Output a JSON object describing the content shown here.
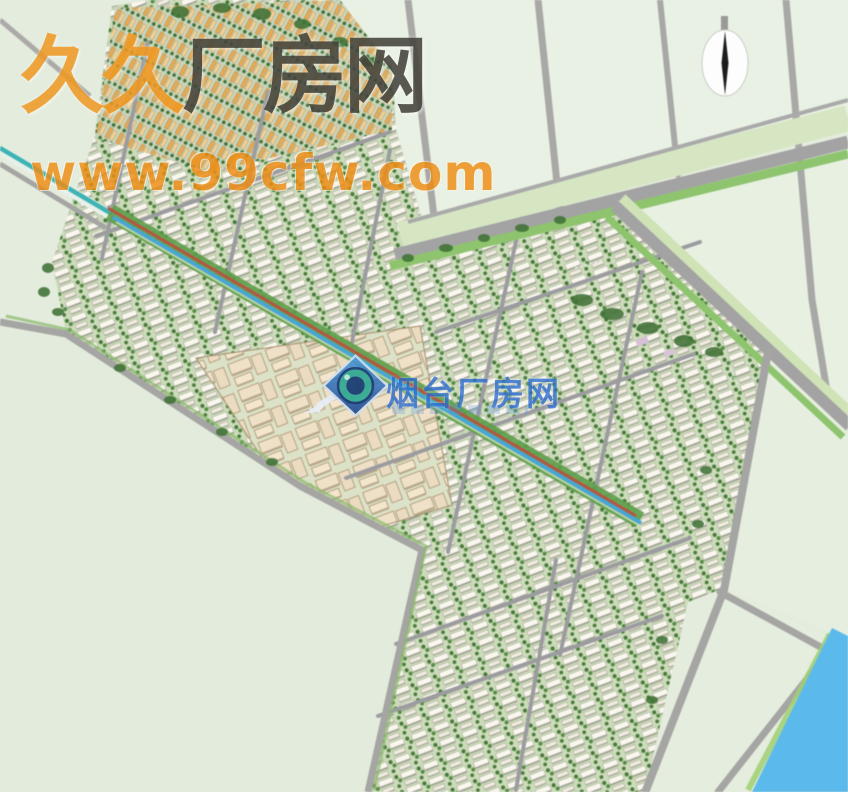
{
  "watermarks": {
    "brand_title": {
      "part1": "久久",
      "part2": "厂房网"
    },
    "brand_url": "www.99cfw.com",
    "center_logo_text": "烟台厂房网"
  },
  "icons": {
    "compass": "north-arrow-icon",
    "center_logo": "yantai-cfw-logo-icon"
  },
  "colors": {
    "wm-orange": "#f09820",
    "wm-orange2": "#ee8c12",
    "wm-dark": "#45443c",
    "wm-blue": "#2a6bd0",
    "logo-teal": "#2fa893",
    "map-background": "#e4ecdc",
    "field-light": "#e9f1e4",
    "road-gray": "#a5a5a3",
    "verge-green": "#8cc56b",
    "tree-green": "#3f7334",
    "river-blue": "#58bbee",
    "canal-teal": "#3ab4b6",
    "boulevard-red": "#b8543f",
    "boulevard-blue": "#43a7d8",
    "building-white": "#f9f7ee",
    "building-beige": "#f0e1c6",
    "building-orange": "#ebab52"
  }
}
